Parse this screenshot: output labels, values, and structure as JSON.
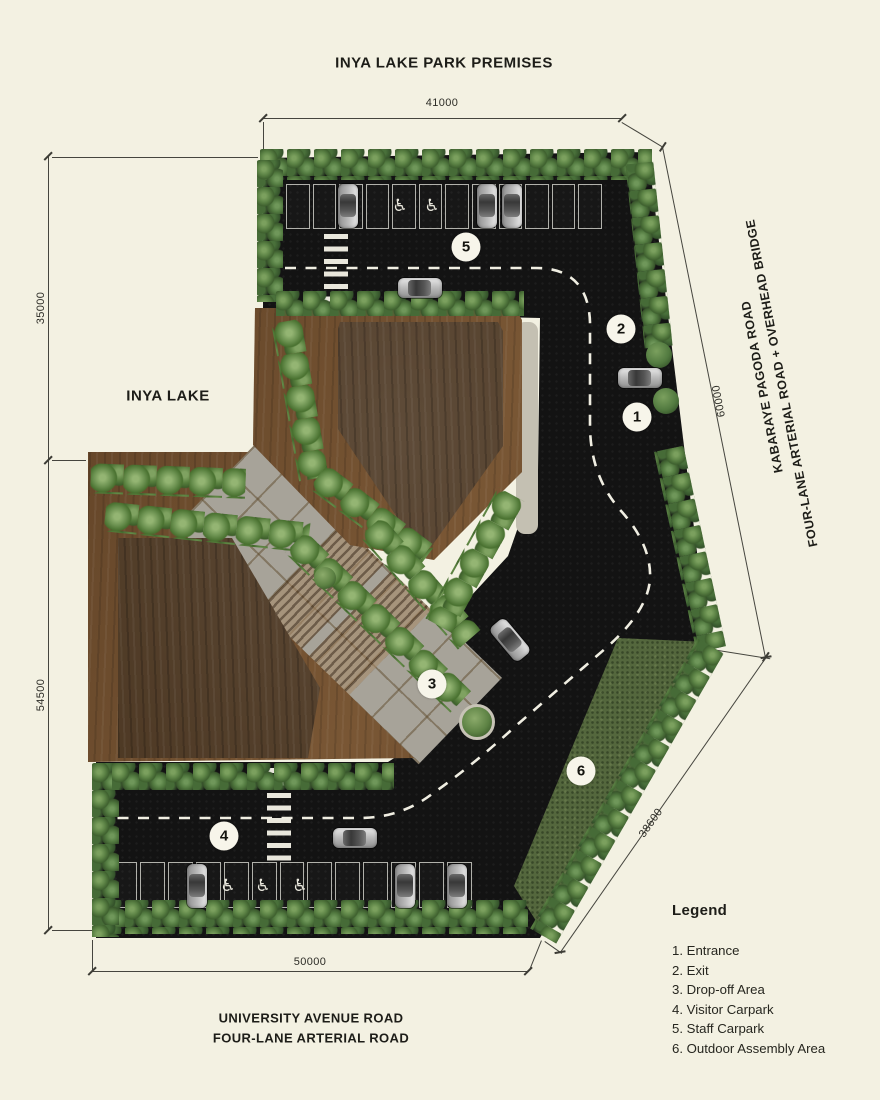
{
  "title": "INYA LAKE PARK PREMISES",
  "site": {
    "lake_label": "INYA LAKE",
    "right_road": {
      "line1": "KABARAYE PAGODA ROAD",
      "line2": "FOUR-LANE ARTERIAL ROAD + OVERHEAD BRIDGE"
    },
    "bottom_road": {
      "line1": "UNIVERSITY AVENUE ROAD",
      "line2": "FOUR-LANE ARTERIAL ROAD"
    }
  },
  "dimensions": {
    "top": "41000",
    "left_upper": "35000",
    "left_lower": "54500",
    "right": "60000",
    "bottom": "50000",
    "diagonal": "38600"
  },
  "markers": [
    "1",
    "2",
    "3",
    "4",
    "5",
    "6"
  ],
  "legend": {
    "heading": "Legend",
    "items": [
      "1. Entrance",
      "2. Exit",
      "3. Drop-off Area",
      "4. Visitor Carpark",
      "5. Staff Carpark",
      "6. Outdoor Assembly Area"
    ]
  },
  "icons": {
    "accessible": "♿"
  },
  "colors": {
    "background": "#f3f1e2",
    "asphalt": "#131313",
    "grass": "#54673d",
    "deck_wood": "#6e4e2f",
    "building_wood": "#4c3722",
    "plaza": "#a7a399",
    "hedge_green": "#527a40",
    "marker_bg": "#f7f5ea",
    "line": "#3c3c35"
  }
}
